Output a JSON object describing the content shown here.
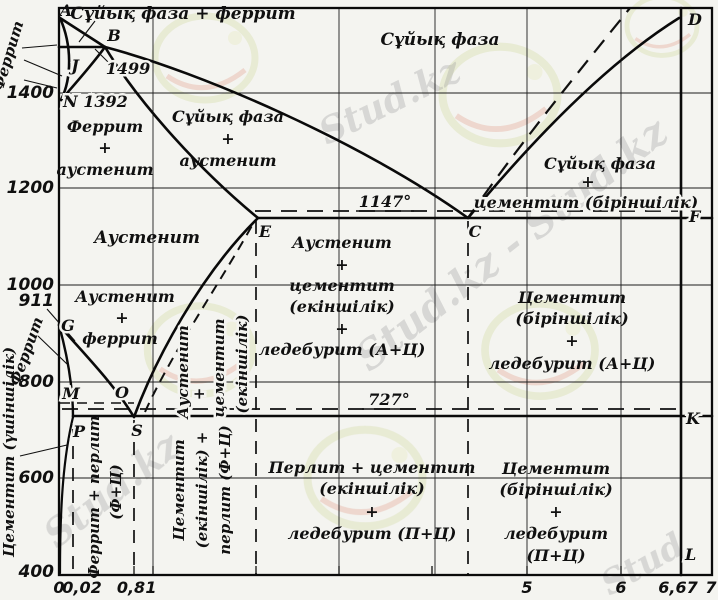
{
  "chart_data": {
    "type": "line",
    "title": "Fe–Fe3C (темір–цементит) күй диаграммасы",
    "xlabel": "",
    "ylabel": "",
    "xlim": [
      0,
      7
    ],
    "ylim": [
      400,
      1560
    ],
    "grid": true,
    "x_tick_labels": [
      "0",
      "0,02",
      "0,8",
      "1",
      "5",
      "6",
      "6,67",
      "7"
    ],
    "y_tick_labels": [
      "400",
      "600",
      "800",
      "911",
      "1000",
      "1200",
      "1400"
    ],
    "isotherms": [
      {
        "label": "1147°",
        "temp_c": 1147
      },
      {
        "label": "727°",
        "temp_c": 727
      }
    ],
    "key_points": {
      "A": [
        0,
        1540
      ],
      "B": [
        0.5,
        1499
      ],
      "J": [
        0.16,
        1499
      ],
      "N": [
        0,
        1392
      ],
      "G": [
        0,
        911
      ],
      "E": [
        2.14,
        1147
      ],
      "C": [
        4.3,
        1147
      ],
      "F": [
        6.67,
        1147
      ],
      "P": [
        0.02,
        727
      ],
      "S": [
        0.8,
        727
      ],
      "K": [
        6.67,
        727
      ],
      "M": [
        0,
        768
      ],
      "O": [
        0.5,
        768
      ],
      "D": [
        6.67,
        1560
      ],
      "L": [
        6.67,
        400
      ]
    },
    "series": [
      {
        "name": "liquidus A-B",
        "points": [
          [
            0,
            1540
          ],
          [
            0.5,
            1499
          ]
        ]
      },
      {
        "name": "liquidus B-C",
        "points": [
          [
            0.5,
            1499
          ],
          [
            4.3,
            1147
          ]
        ]
      },
      {
        "name": "liquidus C-D",
        "points": [
          [
            4.3,
            1147
          ],
          [
            6.67,
            1560
          ]
        ]
      },
      {
        "name": "peritectic H-B 1499",
        "points": [
          [
            0,
            1499
          ],
          [
            0.5,
            1499
          ]
        ]
      },
      {
        "name": "solidus J-E",
        "points": [
          [
            0.5,
            1499
          ],
          [
            2.14,
            1147
          ]
        ]
      },
      {
        "name": "A-N delta boundary",
        "points": [
          [
            0,
            1540
          ],
          [
            0,
            1392
          ]
        ]
      },
      {
        "name": "eutectic E-C-F 1147",
        "points": [
          [
            2.14,
            1147
          ],
          [
            6.67,
            1147
          ]
        ]
      },
      {
        "name": "G-S (A3)",
        "points": [
          [
            0,
            911
          ],
          [
            0.8,
            727
          ]
        ]
      },
      {
        "name": "G-P",
        "points": [
          [
            0,
            911
          ],
          [
            0.02,
            727
          ]
        ]
      },
      {
        "name": "S-E (Acm)",
        "points": [
          [
            0.8,
            727
          ],
          [
            2.14,
            1147
          ]
        ]
      },
      {
        "name": "eutectoid P-S-K 727",
        "points": [
          [
            0.02,
            727
          ],
          [
            6.67,
            727
          ]
        ]
      },
      {
        "name": "P-Q ferrite solvus",
        "points": [
          [
            0.02,
            727
          ],
          [
            0,
            400
          ]
        ]
      },
      {
        "name": "M-O Curie (dashed)",
        "points": [
          [
            0,
            768
          ],
          [
            0.5,
            768
          ]
        ]
      },
      {
        "name": "cementite line D-F-K-L",
        "points": [
          [
            6.67,
            1560
          ],
          [
            6.67,
            400
          ]
        ]
      }
    ]
  },
  "axis": {
    "y": [
      "1400",
      "1200",
      "1000",
      "911",
      "800",
      "600",
      "400"
    ],
    "x": [
      "0",
      "0,02",
      "0,8",
      "1",
      "5",
      "6",
      "6,67",
      "7"
    ]
  },
  "isotherms": {
    "eutectic": "1147°",
    "eutectoid": "727°"
  },
  "points": {
    "A": "A",
    "B": "B",
    "B_temp": "1499",
    "J": "J",
    "N": "N 1392",
    "D": "D",
    "E": "E",
    "C": "C",
    "F": "F",
    "K": "K",
    "L": "L",
    "G": "G",
    "M": "M",
    "O": "O",
    "P": "P",
    "S": "S"
  },
  "regions": {
    "liq_fer": "Сұйық фаза + феррит",
    "liq": "Сұйық фаза",
    "fer_aus": [
      "Феррит",
      "+",
      "аустенит"
    ],
    "liq_aus": [
      "Сұйық фаза",
      "+",
      "аустенит"
    ],
    "aus": "Аустенит",
    "aus_fer": [
      "Аустенит",
      "+",
      "феррит"
    ],
    "aus_cem2": [
      "Аустенит",
      "+",
      "цементит",
      "(екіншілік)"
    ],
    "aus_cem_led": [
      "Аустенит",
      "+",
      "цементит",
      "(екіншілік)",
      "+",
      "ледебурит (А+Ц)"
    ],
    "liq_cem1": [
      "Сұйық фаза",
      "+",
      "цементит (біріншілік)"
    ],
    "cem1_led_a": [
      "Цементит",
      "(біріншілік)",
      "+",
      "ледебурит (А+Ц)"
    ],
    "per_cem_led": [
      "Перлит + цементит",
      "(екіншілік)",
      "+",
      "ледебурит (П+Ц)"
    ],
    "cem1_led_p": [
      "Цементит",
      "(біріншілік)",
      "+",
      "ледебурит",
      "(П+Ц)"
    ],
    "fer_per": [
      "Феррит + перлит",
      "(Ф+Ц)"
    ],
    "cem2_per": [
      "Цементит",
      "(екіншілік) +",
      "перлит (Ф+Ц)"
    ]
  },
  "side_labels": {
    "ferrite_top": "Феррит",
    "ferrite_mid": "Феррит",
    "cementite_tertiary": "Цементит (үшіншілік)"
  },
  "watermark": {
    "full": "Stud.kz - Stud.kz",
    "short": "Stud.kz",
    "stub": "Stud"
  }
}
